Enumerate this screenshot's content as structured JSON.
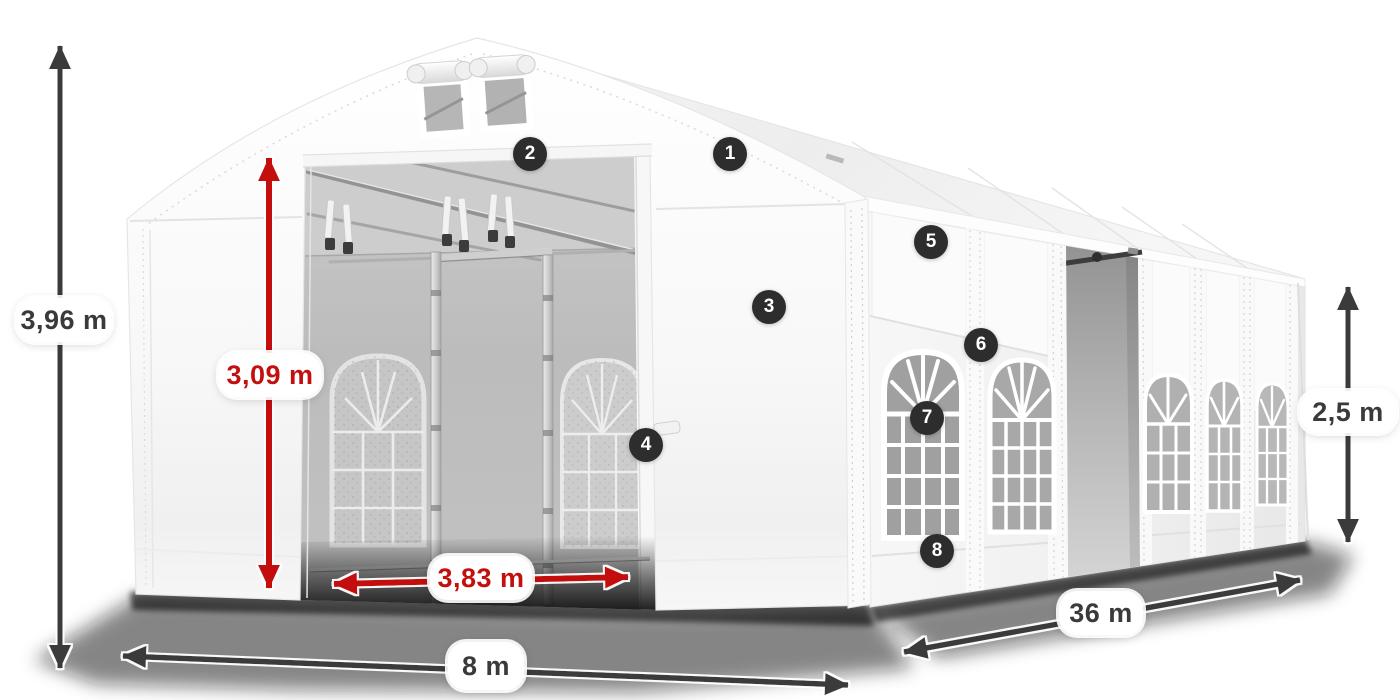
{
  "diagram": {
    "type": "product-dimension-diagram",
    "subject": "marquee-tent",
    "dimension_labels": {
      "total_height": "3,96 m",
      "entrance_height": "3,09 m",
      "entrance_width": "3,83 m",
      "front_width": "8 m",
      "side_length": "36 m",
      "side_wall_height": "2,5 m"
    },
    "badges": [
      {
        "number": "1"
      },
      {
        "number": "2"
      },
      {
        "number": "3"
      },
      {
        "number": "4"
      },
      {
        "number": "5"
      },
      {
        "number": "6"
      },
      {
        "number": "7"
      },
      {
        "number": "8"
      }
    ],
    "colors": {
      "dimension_primary": "#3a3a3a",
      "dimension_accent_red": "#c40f0f",
      "badge_background": "#2d2d2d",
      "badge_text": "#ffffff"
    }
  }
}
